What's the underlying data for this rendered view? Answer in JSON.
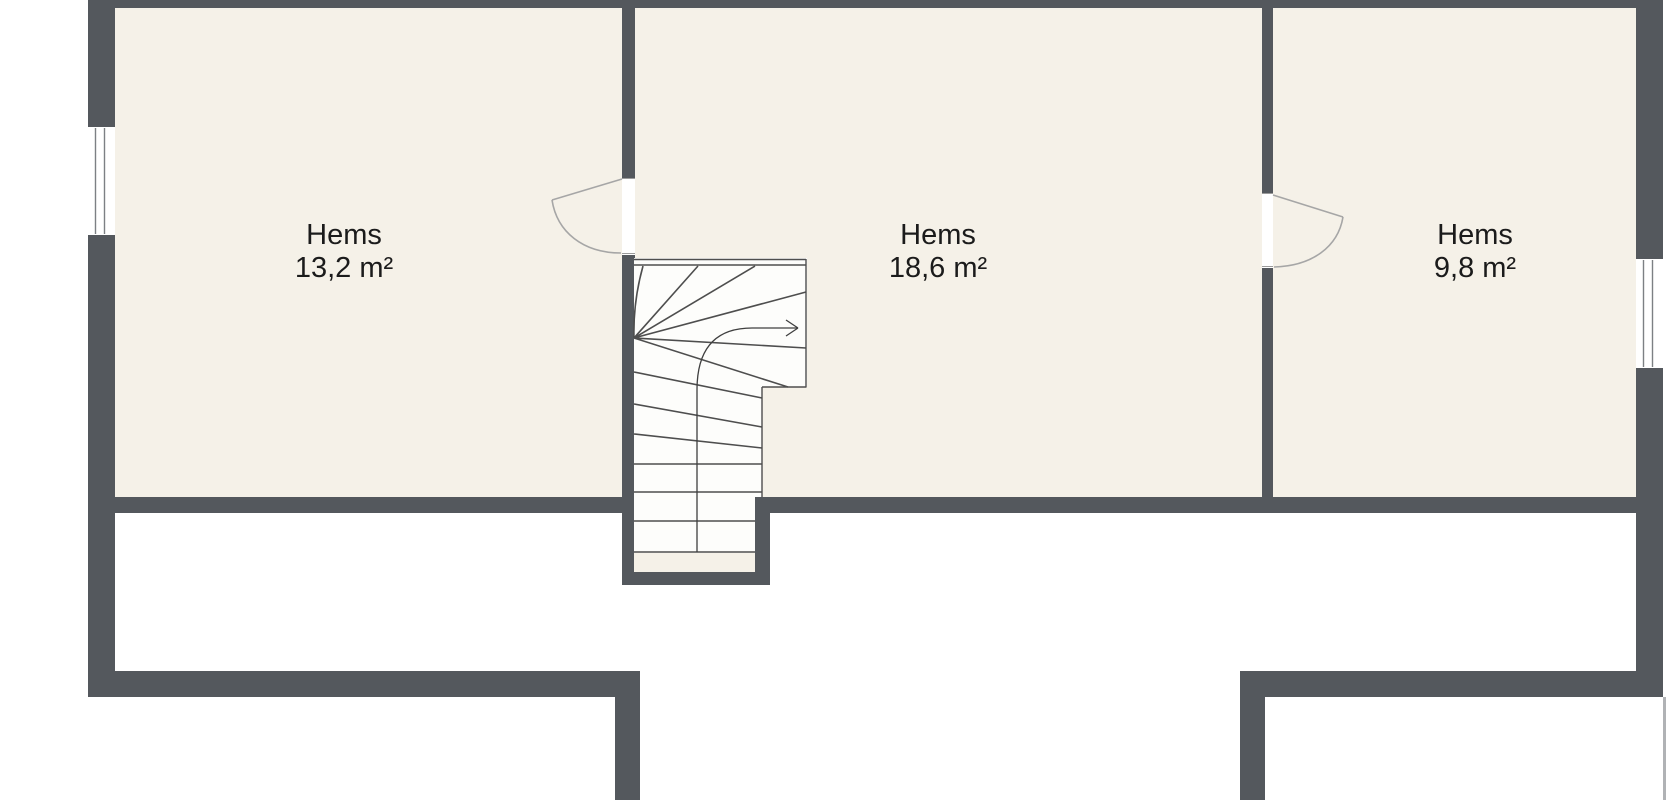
{
  "plan": {
    "rooms": [
      {
        "name": "Hems",
        "area": "13,2 m²"
      },
      {
        "name": "Hems",
        "area": "18,6 m²"
      },
      {
        "name": "Hems",
        "area": "9,8 m²"
      }
    ],
    "stair": {
      "arrow_icon": "arrow-right",
      "direction": "up"
    }
  },
  "colors": {
    "wall": "#54585d",
    "floor": "#f5f1e8",
    "background": "#ffffff",
    "stair_lines": "#4e4e4e",
    "door_arc": "#a6a6a6",
    "window_line": "#7d8084",
    "text": "#1b1b1b"
  }
}
